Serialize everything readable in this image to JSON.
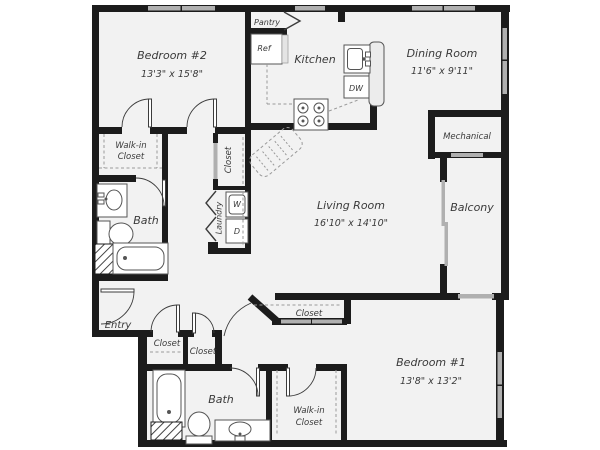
{
  "plan": {
    "rooms": {
      "bedroom2": {
        "name": "Bedroom #2",
        "dims": "13'3\" x 15'8\""
      },
      "kitchen": {
        "name": "Kitchen"
      },
      "dining": {
        "name": "Dining Room",
        "dims": "11'6\" x 9'11\""
      },
      "mechanical": {
        "name": "Mechanical"
      },
      "balcony": {
        "name": "Balcony"
      },
      "living": {
        "name": "Living Room",
        "dims": "16'10\" x 14'10\""
      },
      "bedroom1": {
        "name": "Bedroom #1",
        "dims": "13'8\" x 13'2\""
      },
      "bath_upper": {
        "name": "Bath"
      },
      "bath_lower": {
        "name": "Bath"
      },
      "entry": {
        "name": "Entry"
      },
      "laundry": {
        "name": "Laundry"
      },
      "walkin_upper": {
        "line1": "Walk-in",
        "line2": "Closet"
      },
      "walkin_lower": {
        "line1": "Walk-in",
        "line2": "Closet"
      }
    },
    "labels": {
      "pantry": "Pantry",
      "ref": "Ref",
      "dw": "DW",
      "washer": "W",
      "dryer": "D",
      "closet_mid": "Closet",
      "closet_entry1": "Closet",
      "closet_entry2": "Closet",
      "closet_hall": "Closet"
    },
    "colors": {
      "wall": "#1c1c1c",
      "floor": "#f2f2f2",
      "window": "#b0b0b0",
      "fixture": "#555555",
      "text": "#3a3a3a",
      "dash": "#999999"
    }
  }
}
